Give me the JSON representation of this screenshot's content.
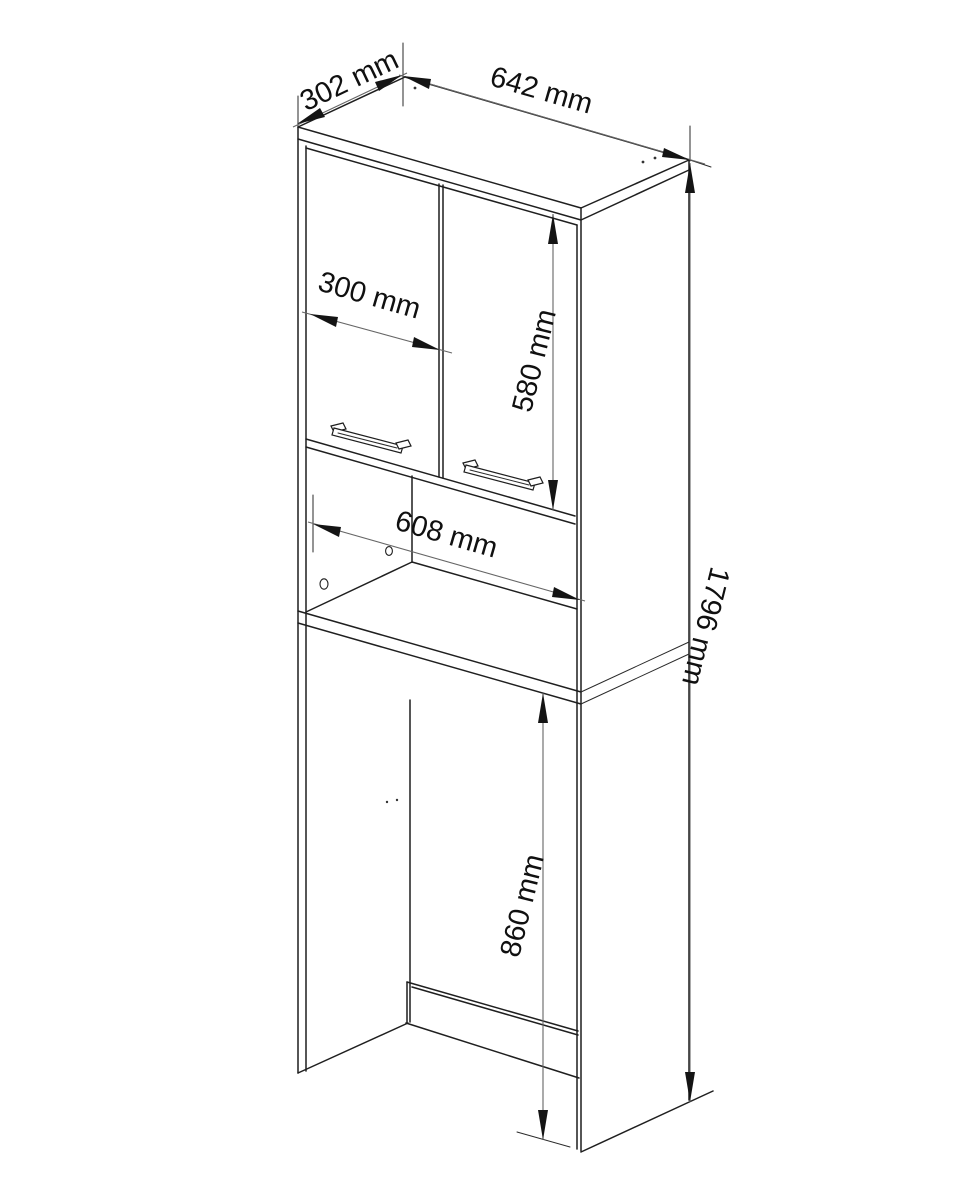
{
  "drawing": {
    "type": "furniture technical drawing",
    "colors": {
      "background": "#ffffff",
      "object_line": "#1f1f1f",
      "dimension_line": "#666666",
      "text": "#101010"
    },
    "dimensions": {
      "depth": "302 mm",
      "width": "642 mm",
      "door_width": "300 mm",
      "door_height": "580 mm",
      "niche_width": "608 mm",
      "appliance_space_height": "860 mm",
      "total_height": "1796 mm"
    }
  }
}
